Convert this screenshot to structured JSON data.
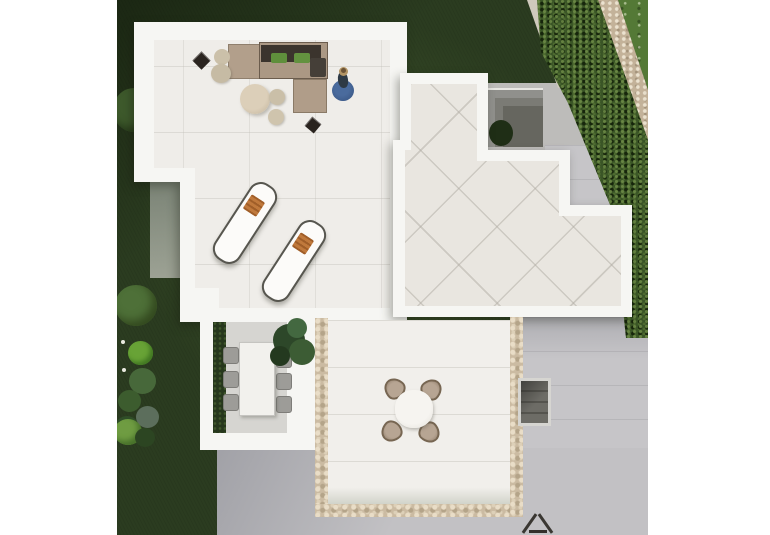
{
  "scene": {
    "type": "aerial 3d architectural render",
    "label": "Top-down view of villa roof terraces, patios and garden",
    "background_color": "#ffffff"
  },
  "palette": {
    "grass_dark": "#2b3c20",
    "lawn_bright": "#547936",
    "hedge_green": "#3a5526",
    "gravel_path": "#c3b299",
    "pavement_gray": "#c6c5c8",
    "wall_white": "#f6f6f3",
    "terrace_tile": "#efede9",
    "roof_tile": "#e9e6e0",
    "patio_tile": "#f1efeb",
    "mosaic_beige": "#cbbba2",
    "sofa_tan": "#ab9884",
    "cushion_dark": "#3b342d",
    "pillow_green": "#5f8f3c",
    "towel_orange": "#c0793c",
    "rug_blue": "#3c5c8e",
    "table_beige": "#d5cab5",
    "plant_green": "#2d4729"
  },
  "areas": {
    "main_terrace": {
      "label": "Main roof terrace with lounge set"
    },
    "roof_terrace": {
      "label": "Stepped roof terrace with diagonal tiles"
    },
    "dining_area": {
      "label": "Covered dining area with table for six"
    },
    "patio": {
      "label": "Mosaic-edged patio with round table"
    },
    "garden": {
      "label": "Garden with dark lawn and shrubs"
    },
    "lawn": {
      "label": "Bright neighbour lawn"
    },
    "hedge": {
      "label": "Boundary hedge"
    },
    "path": {
      "label": "Gravel boundary path"
    },
    "pavement": {
      "label": "Concrete paving"
    },
    "lightwell": {
      "label": "Sunken courtyard"
    },
    "stairwell": {
      "label": "Stair structure"
    }
  },
  "furniture": {
    "sofa": {
      "label": "L-shaped outdoor sofa with dark cushions and green pillows"
    },
    "coffee_table": {
      "label": "Large round coffee table"
    },
    "side_table_small": {
      "label": "Small round side table"
    },
    "poufs": {
      "label": "Round beige poufs",
      "count": 4
    },
    "black_side_tables": {
      "label": "Black square side tables",
      "count": 2
    },
    "loungers": {
      "label": "Sun loungers with orange towels",
      "count": 2
    },
    "person": {
      "label": "Person standing on round blue rug"
    },
    "dining_table": {
      "label": "White rectangular dining table",
      "chair_count": 6
    },
    "patio_table": {
      "label": "Round patio dining table",
      "chair_count": 4
    },
    "plant": {
      "label": "Leafy green plant"
    },
    "dark_object": {
      "label": "Folded dark frame object"
    }
  }
}
